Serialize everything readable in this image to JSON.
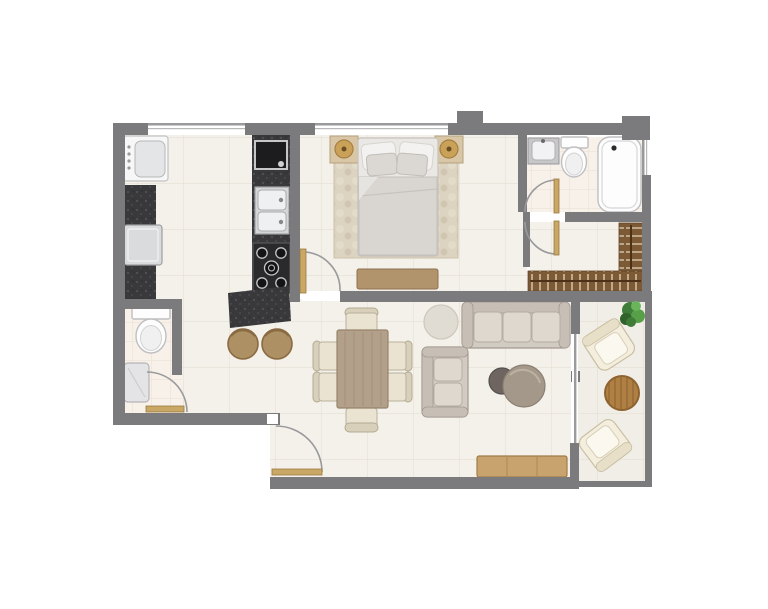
{
  "image_type": "apartment-floor-plan-top-view",
  "palette": {
    "bg": "#ffffff",
    "wall": "#7b7a7c",
    "wallLight": "#9a9a9c",
    "floor": "#f4f1ea",
    "floorLine": "#e8e3d8",
    "floorBath": "#f7f1e9",
    "floorBathLine": "#eadfd2",
    "floorBalc": "#f1eee7",
    "floorBalcLine": "#e5e0d4",
    "counter": "#39383b",
    "counterSpeck": "#56555c",
    "steel": "#d9dbdc",
    "fixture": "#fdfdfd",
    "fixtureLine": "#bfbfc1",
    "doorLeaf": "#c9a765",
    "woodTable": "#b3a08a",
    "woodConsole": "#c9a36d",
    "woodBalcony": "#b07f44",
    "woodRail": "#7c5a36",
    "sofa": "#d2cbc2",
    "sofaLine": "#a29a90",
    "cushion": "#ded8cf",
    "cream": "#eae3d1",
    "bedDuvet": "#d9d6d1",
    "pillow": "#f3f2f0",
    "rugBed": "#dcd3c0",
    "rugRound": "#e1dcd3",
    "stool": "#ad9064",
    "lamp": "#c9a158",
    "plant": "#4a8a40"
  },
  "rooms": [
    {
      "id": "kitchen",
      "items": [
        "washing-machine",
        "refrigerator",
        "left-counter",
        "counter-appliance",
        "double-sink",
        "stove",
        "island-counter",
        "bar-stool-1",
        "bar-stool-2"
      ]
    },
    {
      "id": "bedroom",
      "items": [
        "double-bed",
        "pillows",
        "nightstand-left",
        "lamp-left",
        "nightstand-right",
        "lamp-right",
        "area-rug",
        "foot-bench"
      ]
    },
    {
      "id": "ensuite-bathroom",
      "items": [
        "vanity-sink",
        "toilet",
        "bathtub"
      ]
    },
    {
      "id": "walk-in-closet",
      "items": [
        "hanging-rail-bottom",
        "hanging-rail-side"
      ]
    },
    {
      "id": "guest-bathroom",
      "items": [
        "toilet",
        "shower-tray"
      ]
    },
    {
      "id": "dining-area",
      "items": [
        "dining-table",
        "dining-chair-top",
        "dining-chair-bottom",
        "dining-chair-left-1",
        "dining-chair-left-2",
        "dining-chair-right-1",
        "dining-chair-right-2"
      ]
    },
    {
      "id": "living-area",
      "items": [
        "three-seat-sofa",
        "two-seat-sofa",
        "coffee-table-small",
        "coffee-table-large",
        "round-rug",
        "media-console"
      ]
    },
    {
      "id": "balcony",
      "items": [
        "outdoor-armchair-top",
        "outdoor-armchair-bottom",
        "outdoor-round-table",
        "potted-plant"
      ]
    },
    {
      "id": "entry",
      "items": [
        "entrance-door"
      ]
    }
  ],
  "openings": {
    "windows": [
      "kitchen-window",
      "bedroom-window",
      "bathroom-window"
    ],
    "doors": [
      "entrance-door",
      "bedroom-door",
      "ensuite-door",
      "closet-door",
      "guest-bathroom-door",
      "balcony-sliding-door"
    ]
  }
}
